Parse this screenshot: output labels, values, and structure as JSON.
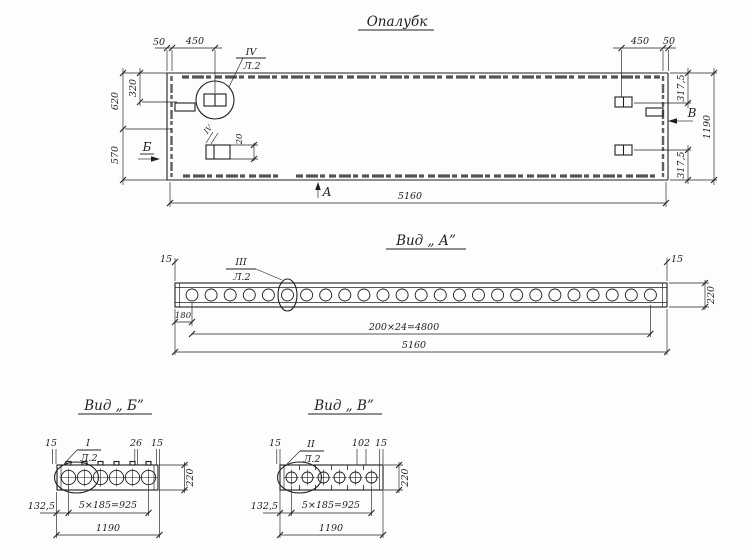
{
  "page": {
    "paper_color": "#fdfdfb",
    "ink_color": "#1f1f1f"
  },
  "plan": {
    "title": "Опалубк",
    "callout_mark": "IV",
    "callout_sheet": "Л.2",
    "detail_mark": "IV",
    "detail_dim": "20",
    "dim_top_left_a": "50",
    "dim_top_left_b": "450",
    "dim_top_right_a": "450",
    "dim_top_right_b": "50",
    "dim_left_outer": "620",
    "dim_left_inner": "320",
    "dim_left_lower": "570",
    "dim_right_top": "317,5",
    "dim_right_overall": "1190",
    "dim_right_bottom": "317,5",
    "dim_bottom": "5160",
    "arrow_b": "Б",
    "arrow_a": "А",
    "arrow_v": "В"
  },
  "view_a": {
    "title": "Вид „ А”",
    "callout_mark": "III",
    "callout_sheet": "Л.2",
    "dim_left_end": "15",
    "dim_right_end": "15",
    "dim_height": "220",
    "dim_first": "180",
    "dim_pitch": "200×24=4800",
    "dim_total": "5160"
  },
  "view_b": {
    "title": "Вид „ Б”",
    "callout_mark": "I",
    "callout_sheet": "Л.2",
    "dim_left_end": "15",
    "dim_mid": "26",
    "dim_right_end": "15",
    "dim_height": "220",
    "dim_left_offset": "132,5",
    "dim_pitch": "5×185=925",
    "dim_total": "1190"
  },
  "view_v": {
    "title": "Вид „ В”",
    "callout_mark": "II",
    "callout_sheet": "Л.2",
    "dim_left_end": "15",
    "dim_mid": "102",
    "dim_right_end": "15",
    "dim_height": "220",
    "dim_left_offset": "132,5",
    "dim_pitch": "5×185=925",
    "dim_total": "1190"
  }
}
